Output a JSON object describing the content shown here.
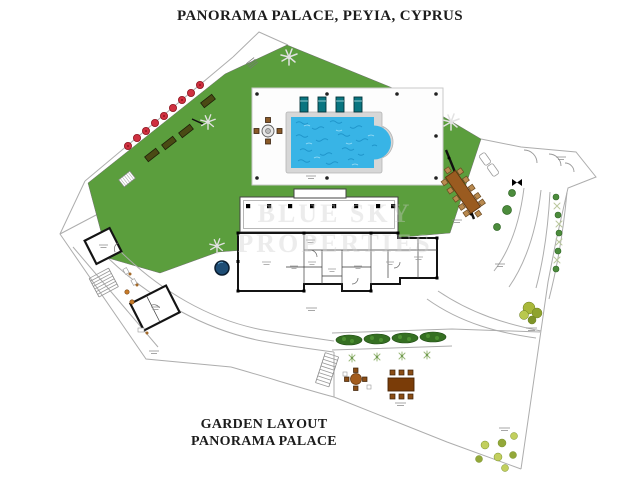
{
  "header": {
    "title": "PANORAMA PALACE, PEYIA, CYPRUS"
  },
  "footer": {
    "line1": "GARDEN LAYOUT",
    "line2": "PANORAMA PALACE"
  },
  "watermark": {
    "line1": "BLUE SKY",
    "line2": "PROPERTIES"
  },
  "plan": {
    "type": "garden-site-plan",
    "colors": {
      "lawn": "#5b9e3d",
      "pool_water": "#38b4e6",
      "pool_ripple": "#1487be",
      "pool_coping": "#d7d7d7",
      "lounger_teal": "#0a7580",
      "wood_brown": "#9a5b20",
      "dark_table_brown": "#7a3c08",
      "red_shrub": "#cf3040",
      "hedge_green": "#356f22",
      "bush_yellow_green": "#b9c84e",
      "boundary_gray": "#adadad",
      "wall_black": "#141414"
    },
    "elements": [
      {
        "name": "lawn-areas",
        "count": 1,
        "note": "large green lawn wrapping pool terrace"
      },
      {
        "name": "swimming-pool",
        "count": 1,
        "note": "rectangular pool with rounded end, on white tiled terrace"
      },
      {
        "name": "sun-loungers-teal",
        "count": 4
      },
      {
        "name": "poolside-round-table-set",
        "count": 1,
        "note": "round table with 4 chairs"
      },
      {
        "name": "red-shrub-row",
        "count": 9,
        "note": "red plants along entrance drive"
      },
      {
        "name": "planter-boxes",
        "count": 4
      },
      {
        "name": "palm-tree-icons",
        "count": 4
      },
      {
        "name": "house-floorplan",
        "count": 1,
        "note": "villa with columned verandah and garage wing"
      },
      {
        "name": "outdoor-dining-pergola",
        "count": 1,
        "note": "long table with 12 seats, north-east of house"
      },
      {
        "name": "white-loungers",
        "count": 2
      },
      {
        "name": "hedge-row",
        "count": 4
      },
      {
        "name": "small-plants-row",
        "count": 4
      },
      {
        "name": "terrace-round-table-set",
        "count": 1
      },
      {
        "name": "terrace-rect-table-set",
        "count": 1,
        "note": "rectangular table with 6 chairs"
      },
      {
        "name": "tree-cluster",
        "count": 1
      },
      {
        "name": "fruit-bushes",
        "count": 7
      },
      {
        "name": "water-feature",
        "count": 1,
        "note": "small round dark-blue feature on lawn edge"
      },
      {
        "name": "outbuildings",
        "count": 2
      },
      {
        "name": "staircases",
        "count": 2
      },
      {
        "name": "entrance-gates",
        "count": 1,
        "note": "gate swing arcs at top-right boundary"
      }
    ]
  }
}
